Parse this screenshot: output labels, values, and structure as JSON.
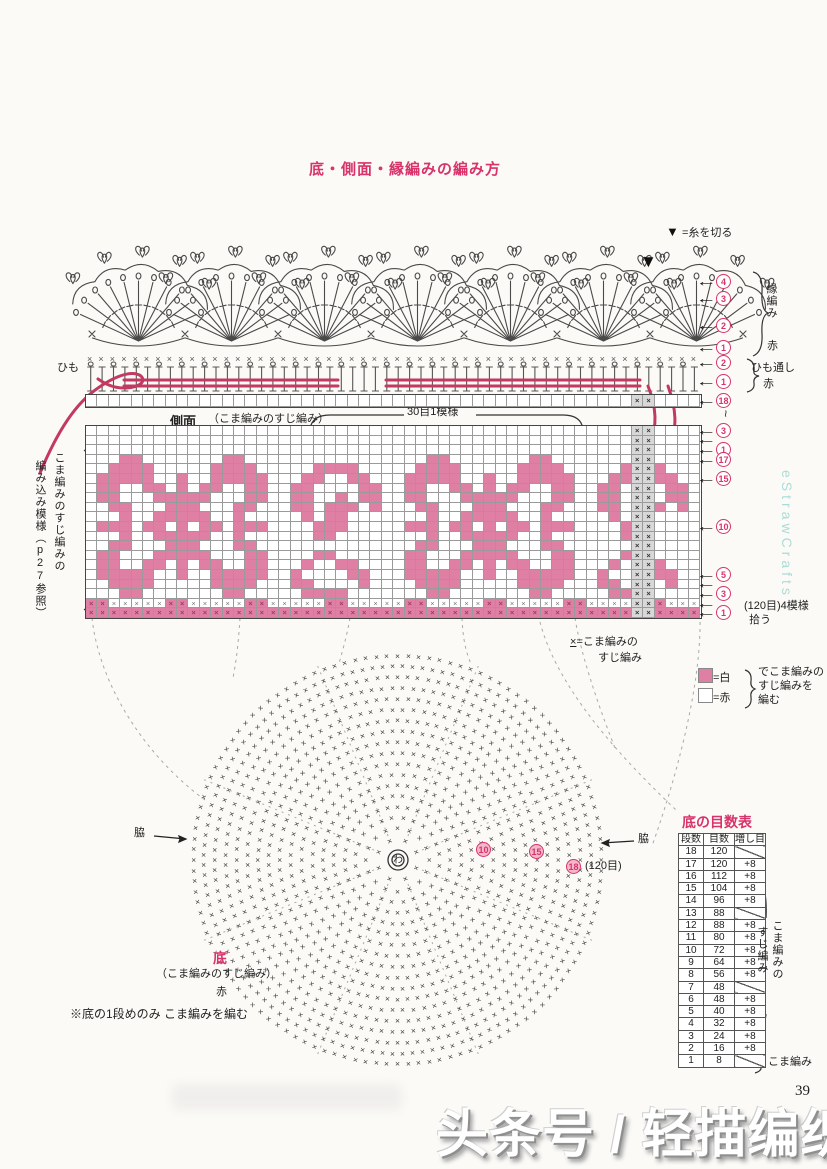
{
  "page": {
    "number": "39"
  },
  "title": {
    "text": "底・側面・縁編みの編み方"
  },
  "thread_cut": {
    "symbol": "▼",
    "text": "=糸を切る"
  },
  "edging": {
    "fans": 7,
    "label": "縁編み",
    "color_label": "赤"
  },
  "cord": {
    "label": "ひも"
  },
  "himo_toshi": {
    "label": "ひも通し",
    "color_label": "赤"
  },
  "side": {
    "label": "側面",
    "sublabel": "（こま編みのすじ編み）",
    "repeat_label": "30目1模様",
    "left_note_col1": "こま編みのすじ編みの",
    "left_note_col2": "編み込み模様（p27参照）",
    "pickup_note": "(120目)4模様",
    "pickup_note2": "拾う",
    "tilde": "~",
    "right_callouts": [
      "4",
      "3",
      "2",
      "1",
      "2",
      "1",
      "18",
      "3",
      "",
      "1",
      "17",
      "15",
      "10",
      "5",
      "",
      "3",
      "",
      "1"
    ],
    "grid": {
      "cols": 54,
      "white_top_rows": 3,
      "marker_cols": [
        48,
        49
      ],
      "tile_rows": [
        "...##.......##.............",
        "..####.....####.....####...",
        ".#####..#..#####...##..##..",
        ".##..##.#.##..##..##....##.",
        ".##...#####...##..##..#.##.",
        "..##...###...##...##.###.#.",
        "...#..#####..#.....#.##....",
        ".###.##.#.##.###....###....",
        "...#..#####..#......##.....",
        "..##...###...##............",
        ".##...#####...##....##.....",
        ".##..##.#.##..##...#..##...",
        ".#####..#..#####..#....##..",
        "..####.....####...##....#..",
        "...##.......##.....####...."
      ]
    }
  },
  "legend_x": {
    "symbol": "×",
    "line1": "=こま編みの",
    "line2": "すじ編み"
  },
  "legend_color": {
    "white_label": "=白",
    "red_label": "=赤",
    "note_line1": "でこま編みの",
    "note_line2": "すじ編みを",
    "note_line3": "編む",
    "swatch_color": "#e07fa4"
  },
  "bottom_chart": {
    "center": "わ",
    "stitch_symbol": "×",
    "waki_left": "脇",
    "waki_right": "脇",
    "marker_10": "10",
    "marker_15": "15",
    "marker_18": "18",
    "marker_18_note": "(120目)",
    "rounds": [
      8,
      16,
      24,
      32,
      40,
      48,
      48,
      56,
      64,
      72,
      80,
      88,
      88,
      96,
      104,
      112,
      120,
      120
    ],
    "title": "底",
    "subtitle": "（こま編みのすじ編み）",
    "color_label": "赤",
    "note": "※底の1段めのみ こま編みを編む"
  },
  "table": {
    "title": "底の目数表",
    "headers": [
      "段数",
      "目数",
      "増し目"
    ],
    "rows": [
      [
        "18",
        "120",
        "/"
      ],
      [
        "17",
        "120",
        "+8"
      ],
      [
        "16",
        "112",
        "+8"
      ],
      [
        "15",
        "104",
        "+8"
      ],
      [
        "14",
        "96",
        "+8"
      ],
      [
        "13",
        "88",
        "/"
      ],
      [
        "12",
        "88",
        "+8"
      ],
      [
        "11",
        "80",
        "+8"
      ],
      [
        "10",
        "72",
        "+8"
      ],
      [
        "9",
        "64",
        "+8"
      ],
      [
        "8",
        "56",
        "+8"
      ],
      [
        "7",
        "48",
        "/"
      ],
      [
        "6",
        "48",
        "+8"
      ],
      [
        "5",
        "40",
        "+8"
      ],
      [
        "4",
        "32",
        "+8"
      ],
      [
        "3",
        "24",
        "+8"
      ],
      [
        "2",
        "16",
        "+8"
      ],
      [
        "1",
        "8",
        "/"
      ]
    ],
    "bracket_label_col1": "こま編みの",
    "bracket_label_col2": "すじ編み",
    "row1_label": "こま編み"
  },
  "watermark": {
    "text": "eStrawCrafts"
  },
  "banner": {
    "text": "头条号 / 轻描编织"
  }
}
